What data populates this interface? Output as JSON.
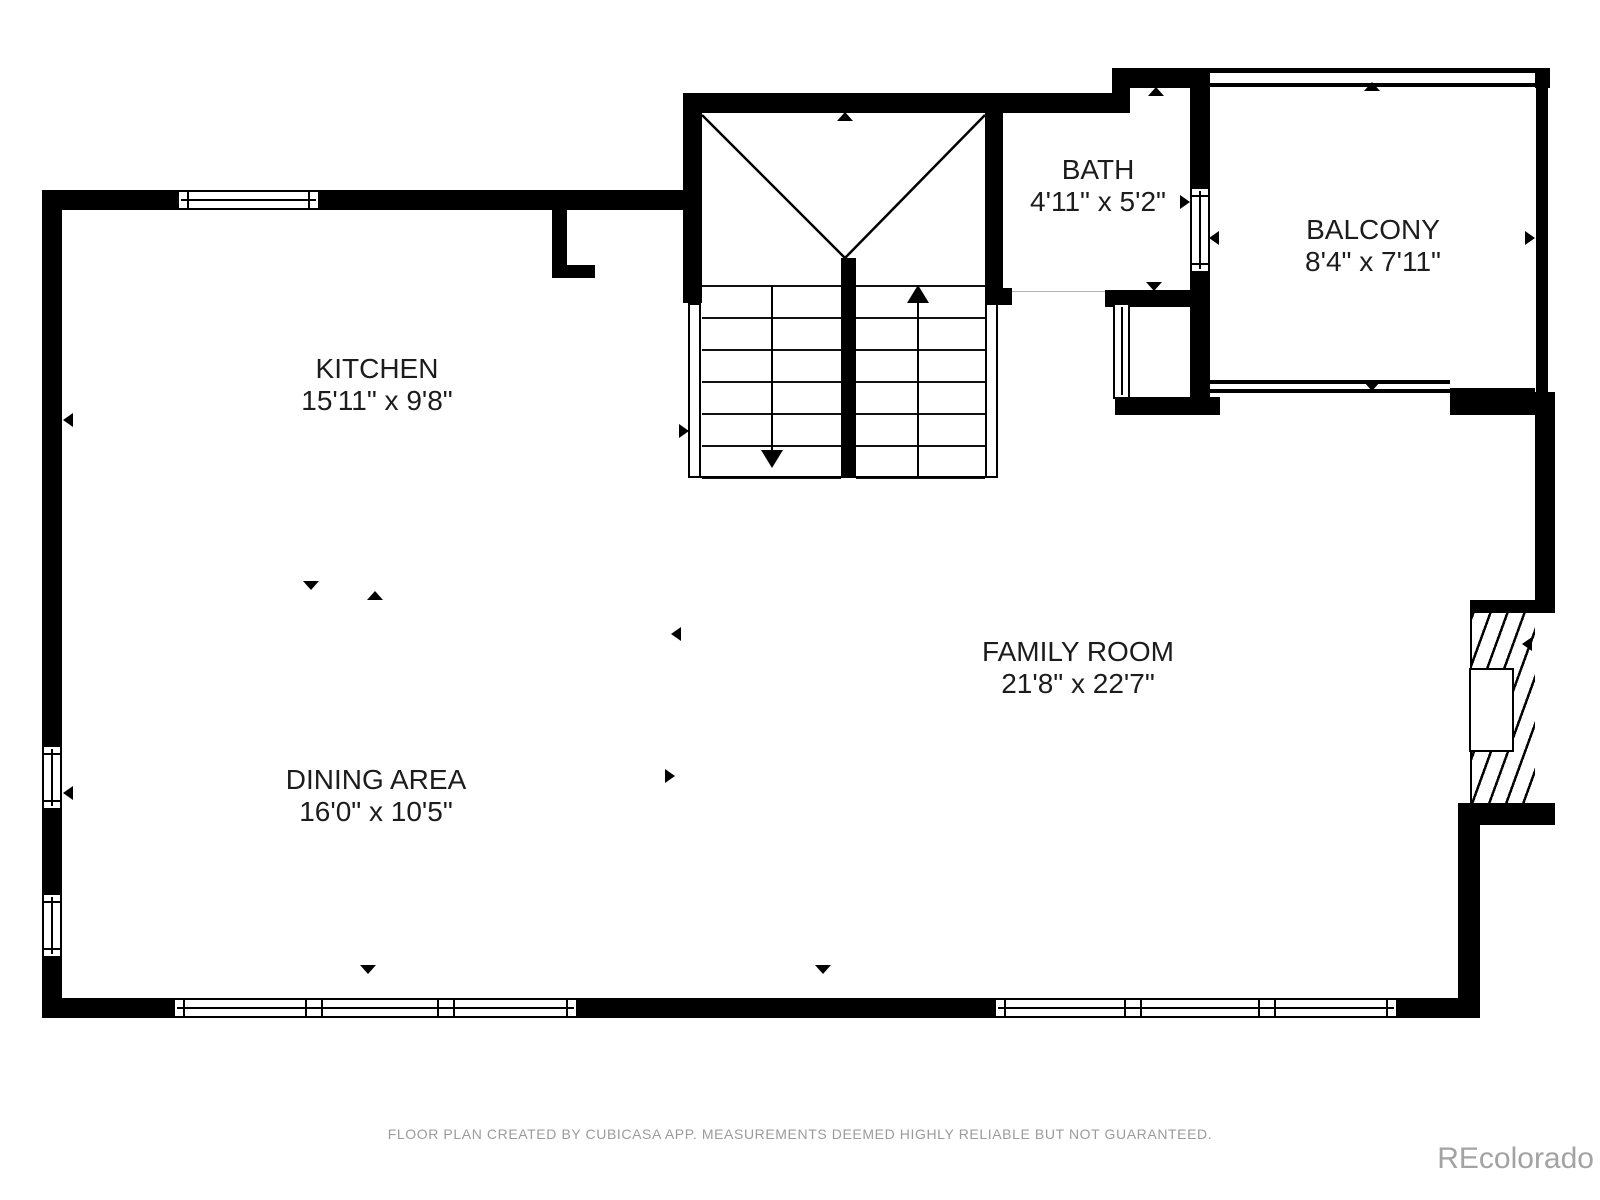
{
  "rooms": [
    {
      "name": "KITCHEN",
      "dims": "15'11\" x 9'8\""
    },
    {
      "name": "DINING AREA",
      "dims": "16'0\" x 10'5\""
    },
    {
      "name": "FAMILY ROOM",
      "dims": "21'8\" x 22'7\""
    },
    {
      "name": "BATH",
      "dims": "4'11\" x 5'2\""
    },
    {
      "name": "BALCONY",
      "dims": "8'4\" x 7'11\""
    }
  ],
  "footer": {
    "disclaimer": "FLOOR PLAN CREATED BY CUBICASA APP. MEASUREMENTS DEEMED HIGHLY RELIABLE BUT NOT GUARANTEED."
  },
  "watermark": {
    "text": "REcolorado"
  },
  "colors": {
    "wall": "#000000",
    "floor": "#ffffff",
    "label_text": "#1c1c1c",
    "muted_text": "#9b9b9b"
  }
}
